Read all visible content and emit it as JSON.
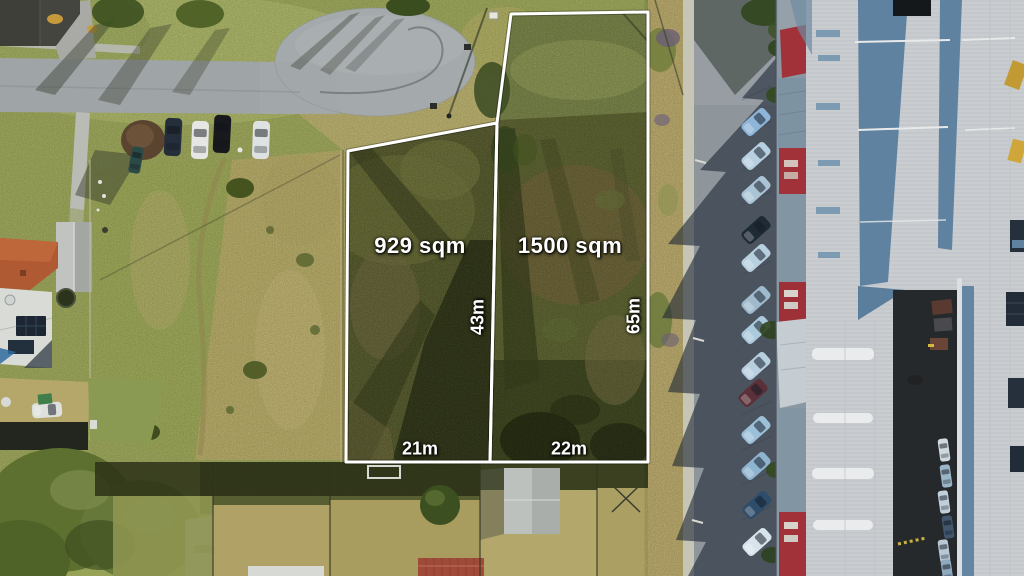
{
  "parcels": [
    {
      "area": "929 sqm",
      "depth": "43m",
      "frontage": "21m"
    },
    {
      "area": "1500 sqm",
      "depth": "65m",
      "frontage": "22m"
    }
  ],
  "overlay": {
    "boundary_color": "#ffffff",
    "label_text_color": "#ffffff"
  },
  "scene_palette": {
    "grass": "#98a257",
    "dry_grass": "#b7a76b",
    "parcel_vegetation": "#4f5429",
    "road": "#9fa4a6",
    "shadowed_road": "#39424d",
    "warehouse_roof": "#c9cdd0",
    "warehouse_red": "#a23239",
    "roof_shadow_blue": "#5f82a0"
  }
}
